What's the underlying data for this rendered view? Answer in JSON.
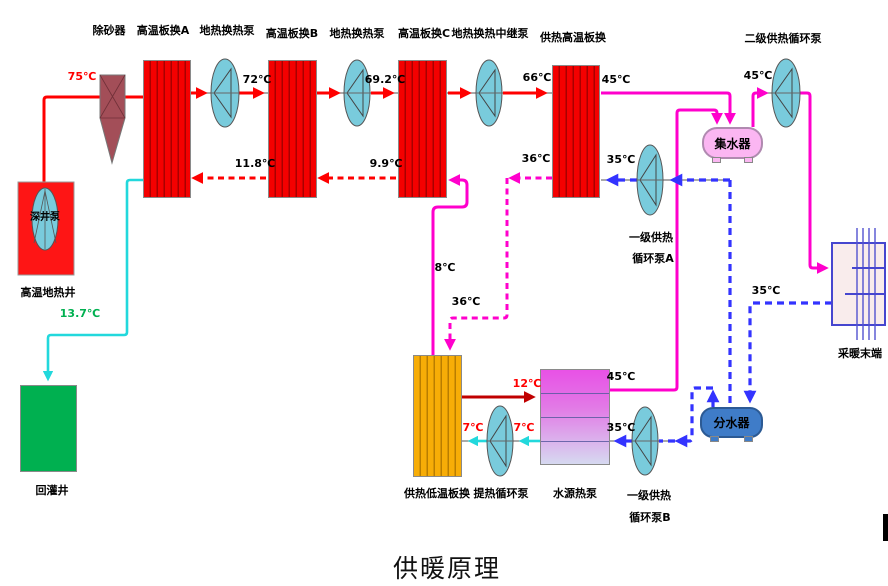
{
  "title": "供暖原理",
  "colors": {
    "hot_supply_red": "#ff0000",
    "heating_supply_magenta": "#ff00cc",
    "heating_return_blue": "#3333ff",
    "reinjection_cyan": "#22d8dc",
    "hp_supply_dark_red": "#c00000",
    "green_label": "#00b050",
    "exchanger_red": "#f40000",
    "exchanger_orange": "#f7ad07",
    "pump_fill": "#79cbdc",
    "collector_pink": "#fbb6f2",
    "distributor_blue": "#3f7cc8"
  },
  "nodes": {
    "sand_remover": {
      "label": "除砂器"
    },
    "hx_a": {
      "label": "高温板换A"
    },
    "pump_geo_1": {
      "label": "地热换热泵"
    },
    "hx_b": {
      "label": "高温板换B"
    },
    "pump_geo_2": {
      "label": "地热换热泵"
    },
    "hx_c": {
      "label": "高温板换C"
    },
    "pump_relay": {
      "label": "地热换热中继泵"
    },
    "hx_heat_high": {
      "label": "供热高温板换"
    },
    "pump_secondary": {
      "label": "二级供热循环泵"
    },
    "collector": {
      "label": "集水器"
    },
    "pump_primary_a": {
      "label_line1": "一级供热",
      "label_line2": "循环泵A"
    },
    "deep_well_pump": {
      "label": "深井泵"
    },
    "hot_well": {
      "label": "高温地热井"
    },
    "reinjection_well": {
      "label": "回灌井"
    },
    "hx_heat_low": {
      "label": "供热低温板换"
    },
    "pump_extract": {
      "label": "提热循环泵"
    },
    "heat_pump": {
      "label": "水源热泵"
    },
    "pump_primary_b": {
      "label_line1": "一级供热",
      "label_line2": "循环泵B"
    },
    "distributor": {
      "label": "分水器"
    },
    "terminal": {
      "label": "采暖末端"
    }
  },
  "temperatures": {
    "t75": "75℃",
    "t72": "72℃",
    "t69_2": "69.2℃",
    "t66": "66℃",
    "t45_hx_out": "45℃",
    "t45_pump2": "45℃",
    "t45_hp_out": "45℃",
    "t11_8": "11.8℃",
    "t9_9": "9.9℃",
    "t36_high": "36℃",
    "t36_low": "36℃",
    "t35_hx_in": "35℃",
    "t35_terminal": "35℃",
    "t35_hp_in": "35℃",
    "t8": "8℃",
    "t13_7": "13.7℃",
    "t12": "12℃",
    "t7_a": "7℃",
    "t7_b": "7℃"
  }
}
